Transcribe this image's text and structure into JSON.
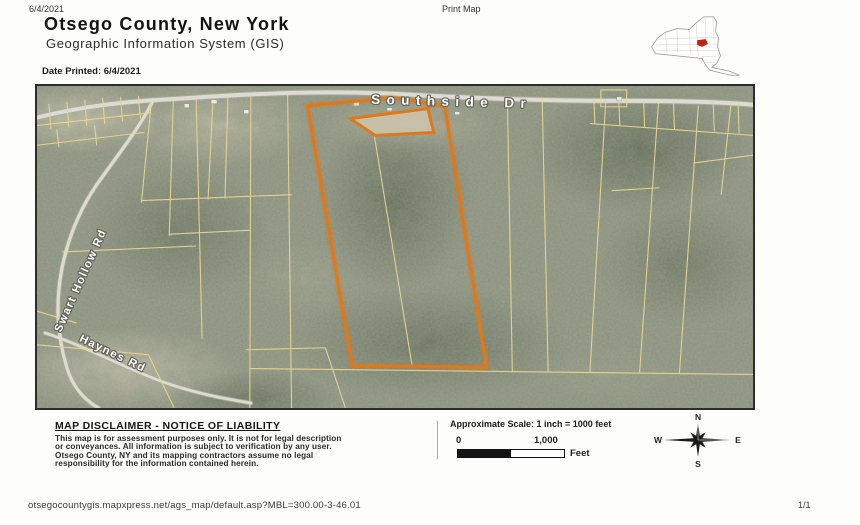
{
  "header": {
    "date": "6/4/2021",
    "print_label": "Print Map",
    "title": "Otsego County, New York",
    "subtitle": "Geographic Information System (GIS)",
    "date_printed": "Date Printed: 6/4/2021"
  },
  "inset": {
    "state_outline_color": "#999590",
    "highlight_color": "#c32112"
  },
  "map": {
    "roads": [
      {
        "label": "Southside Dr"
      },
      {
        "label": "Swart Hollow Rd"
      },
      {
        "label": "Haynes Rd"
      }
    ],
    "colors": {
      "highlight": "#e07818",
      "parcel_line": "#e8d58f",
      "road": "#dcdcd1",
      "road_casing": "#a9a99e",
      "label_halo": "#62625a"
    }
  },
  "footer": {
    "disclaimer_title": "MAP DISCLAIMER - NOTICE OF LIABILITY",
    "disclaimer_lines": [
      "This map is for assessment purposes only. It is not for legal description",
      "or conveyances. All information is subject to verification by any user.",
      "Otsego County, NY and its mapping contractors assume no legal",
      "responsibility for the information contained herein."
    ],
    "scale": {
      "label": "Approximate Scale: 1 inch = 1000 feet",
      "zero": "0",
      "max": "1,000",
      "unit": "Feet"
    },
    "compass": {
      "n": "N",
      "s": "S",
      "e": "E",
      "w": "W"
    },
    "url": "otsegocountygis.mapxpress.net/ags_map/default.asp?MBL=300.00-3-46.01",
    "page_number": "1/1"
  }
}
